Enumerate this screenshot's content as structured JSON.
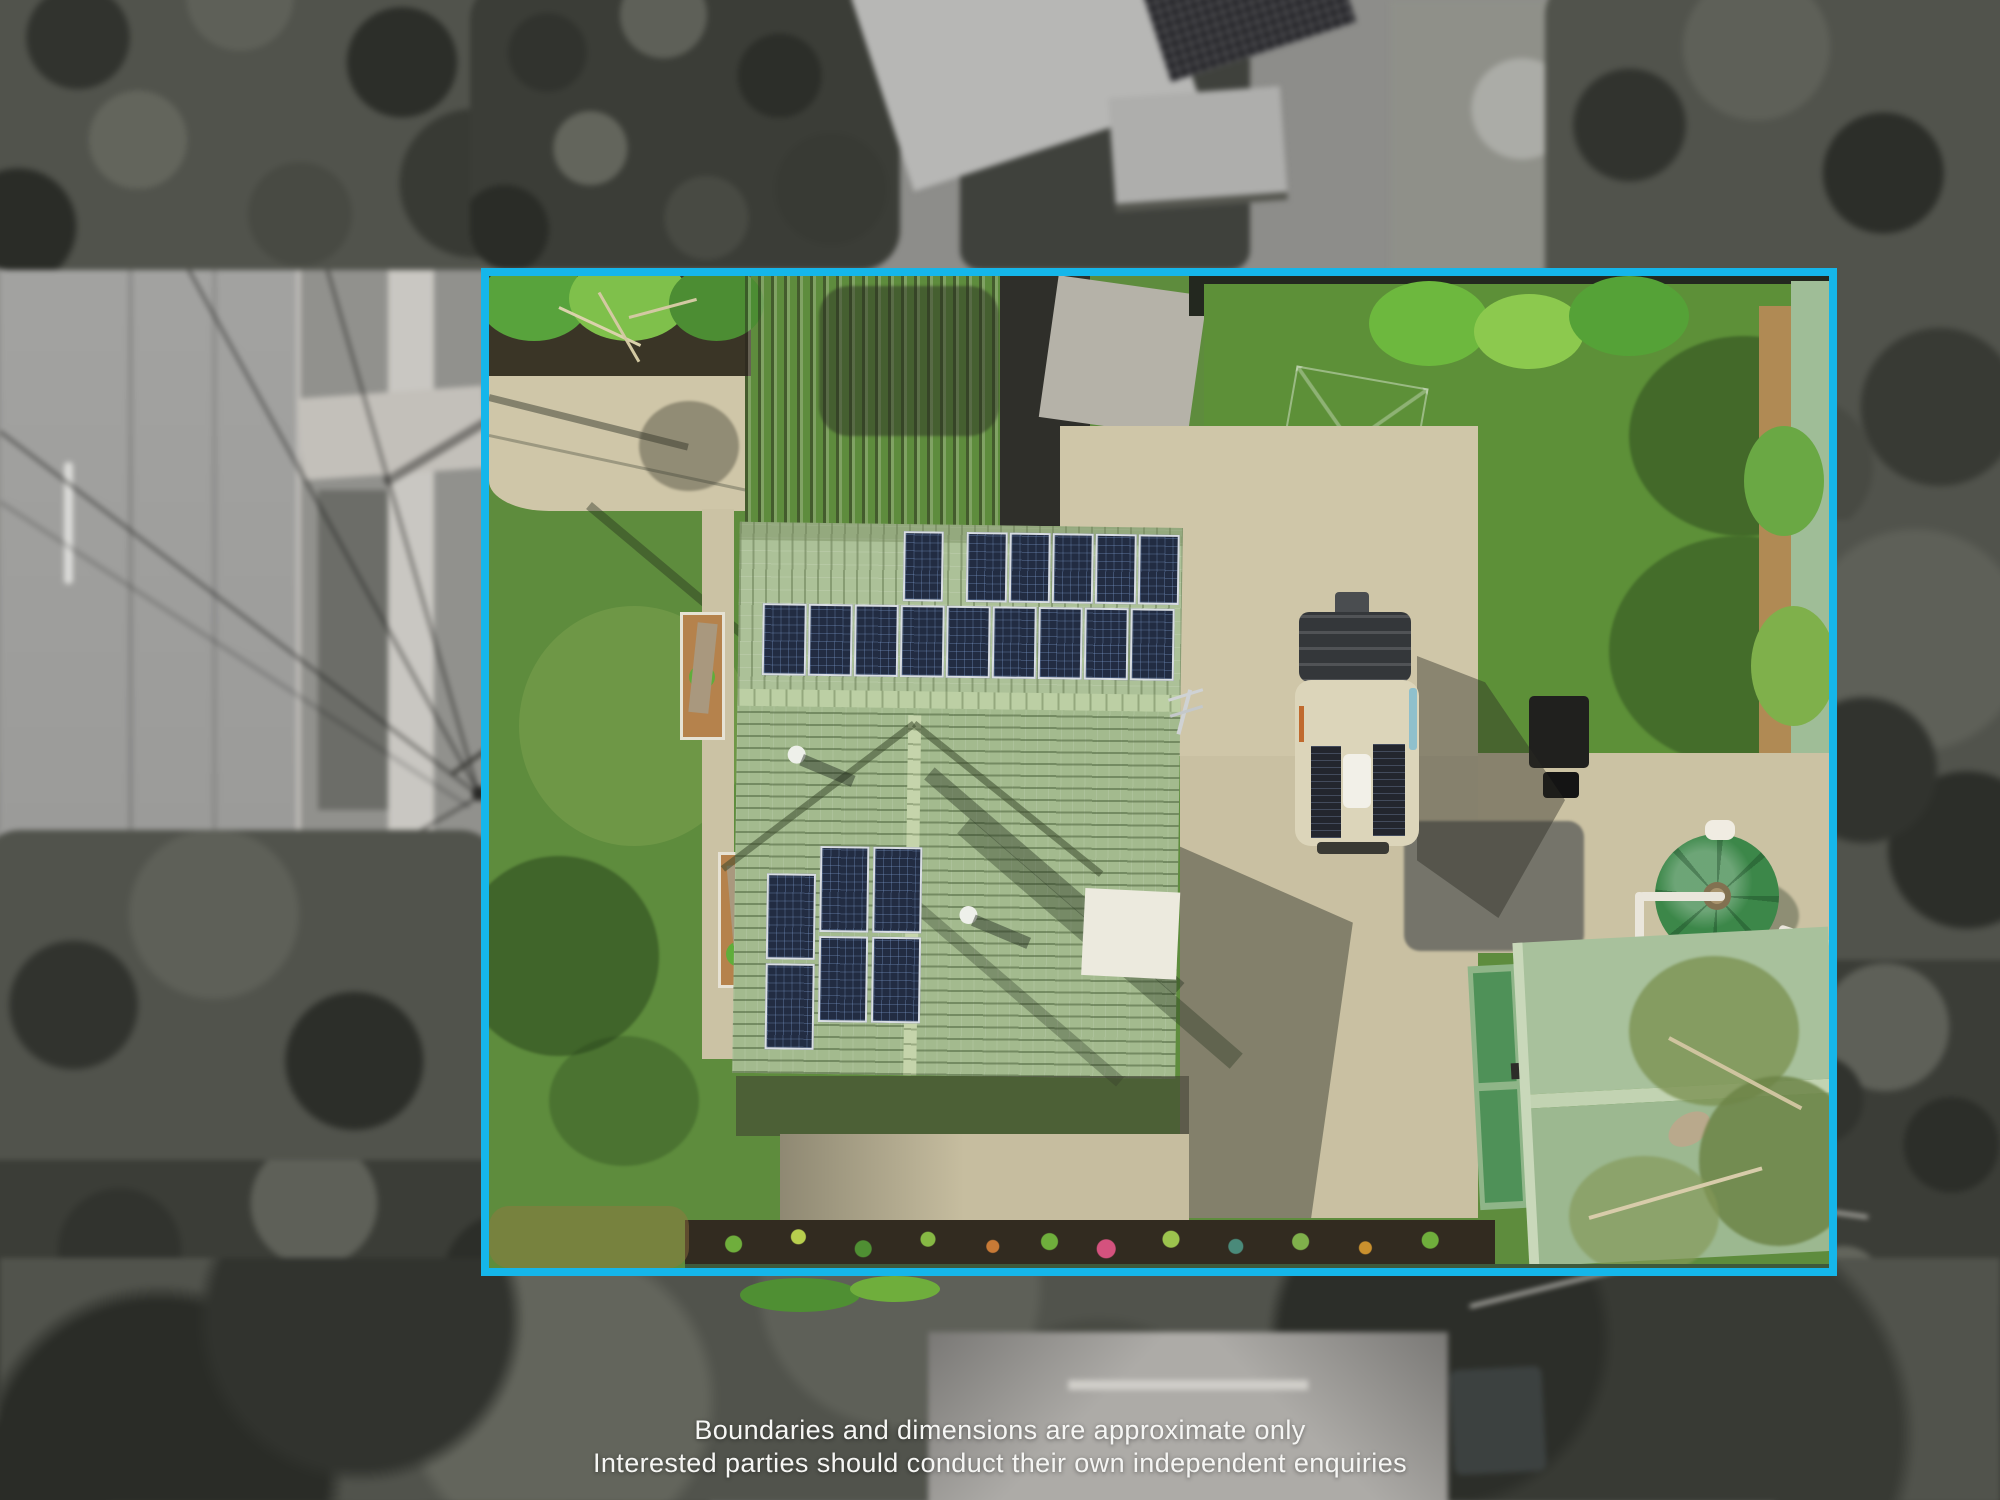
{
  "caption": {
    "line1": "Boundaries and dimensions are approximate only",
    "line2": "Interested parties should conduct their own independent enquiries"
  },
  "boundary": {
    "shape": "rectangle",
    "color": "#15b6ea",
    "meaning": "property-outline-overlay"
  },
  "scene": {
    "style": "aerial-drone-photo, surroundings desaturated and blurred, property in colour",
    "inside_boundary": [
      "front-lawn",
      "front-driveway-concrete",
      "garden-bushes-top-left",
      "old-corrugated-shed-roof",
      "house-pale-green-tile-roof",
      "solar-array-upper-15-panels",
      "solar-array-lower-6-panels",
      "white-carport-panel",
      "tv-antenna",
      "concrete-driveway-east",
      "campervan-with-roof-solar",
      "back-lawn",
      "clothesline-shadow",
      "green-corrugated-fence",
      "water-tank-green",
      "green-garage-shed",
      "patio-concrete",
      "flower-garden-bed",
      "overhanging-tree-branches"
    ],
    "outside_boundary": [
      "street-asphalt",
      "road-centreline-dashes",
      "kerb",
      "footpath",
      "power-lines",
      "power-pole-shadow",
      "neighbour-roofs-top",
      "neighbour-hip-roof-bottom",
      "dense-trees",
      "dead-branches"
    ]
  },
  "palette": {
    "boundary_cyan": "#15b6ea",
    "lawn_green": "#5e8c3d",
    "roof_tile_green": "#abc095",
    "solar_panel_navy": "#222c42",
    "concrete_beige": "#cfc6a8",
    "shed_roof_green": "#a6c09b",
    "shed_door_green": "#4f9158",
    "water_tank_green": "#3c8749",
    "van_body_cream": "#dcd5ba",
    "background_gray": "#8d8d8a",
    "caption_white": "#f6f6f4"
  }
}
